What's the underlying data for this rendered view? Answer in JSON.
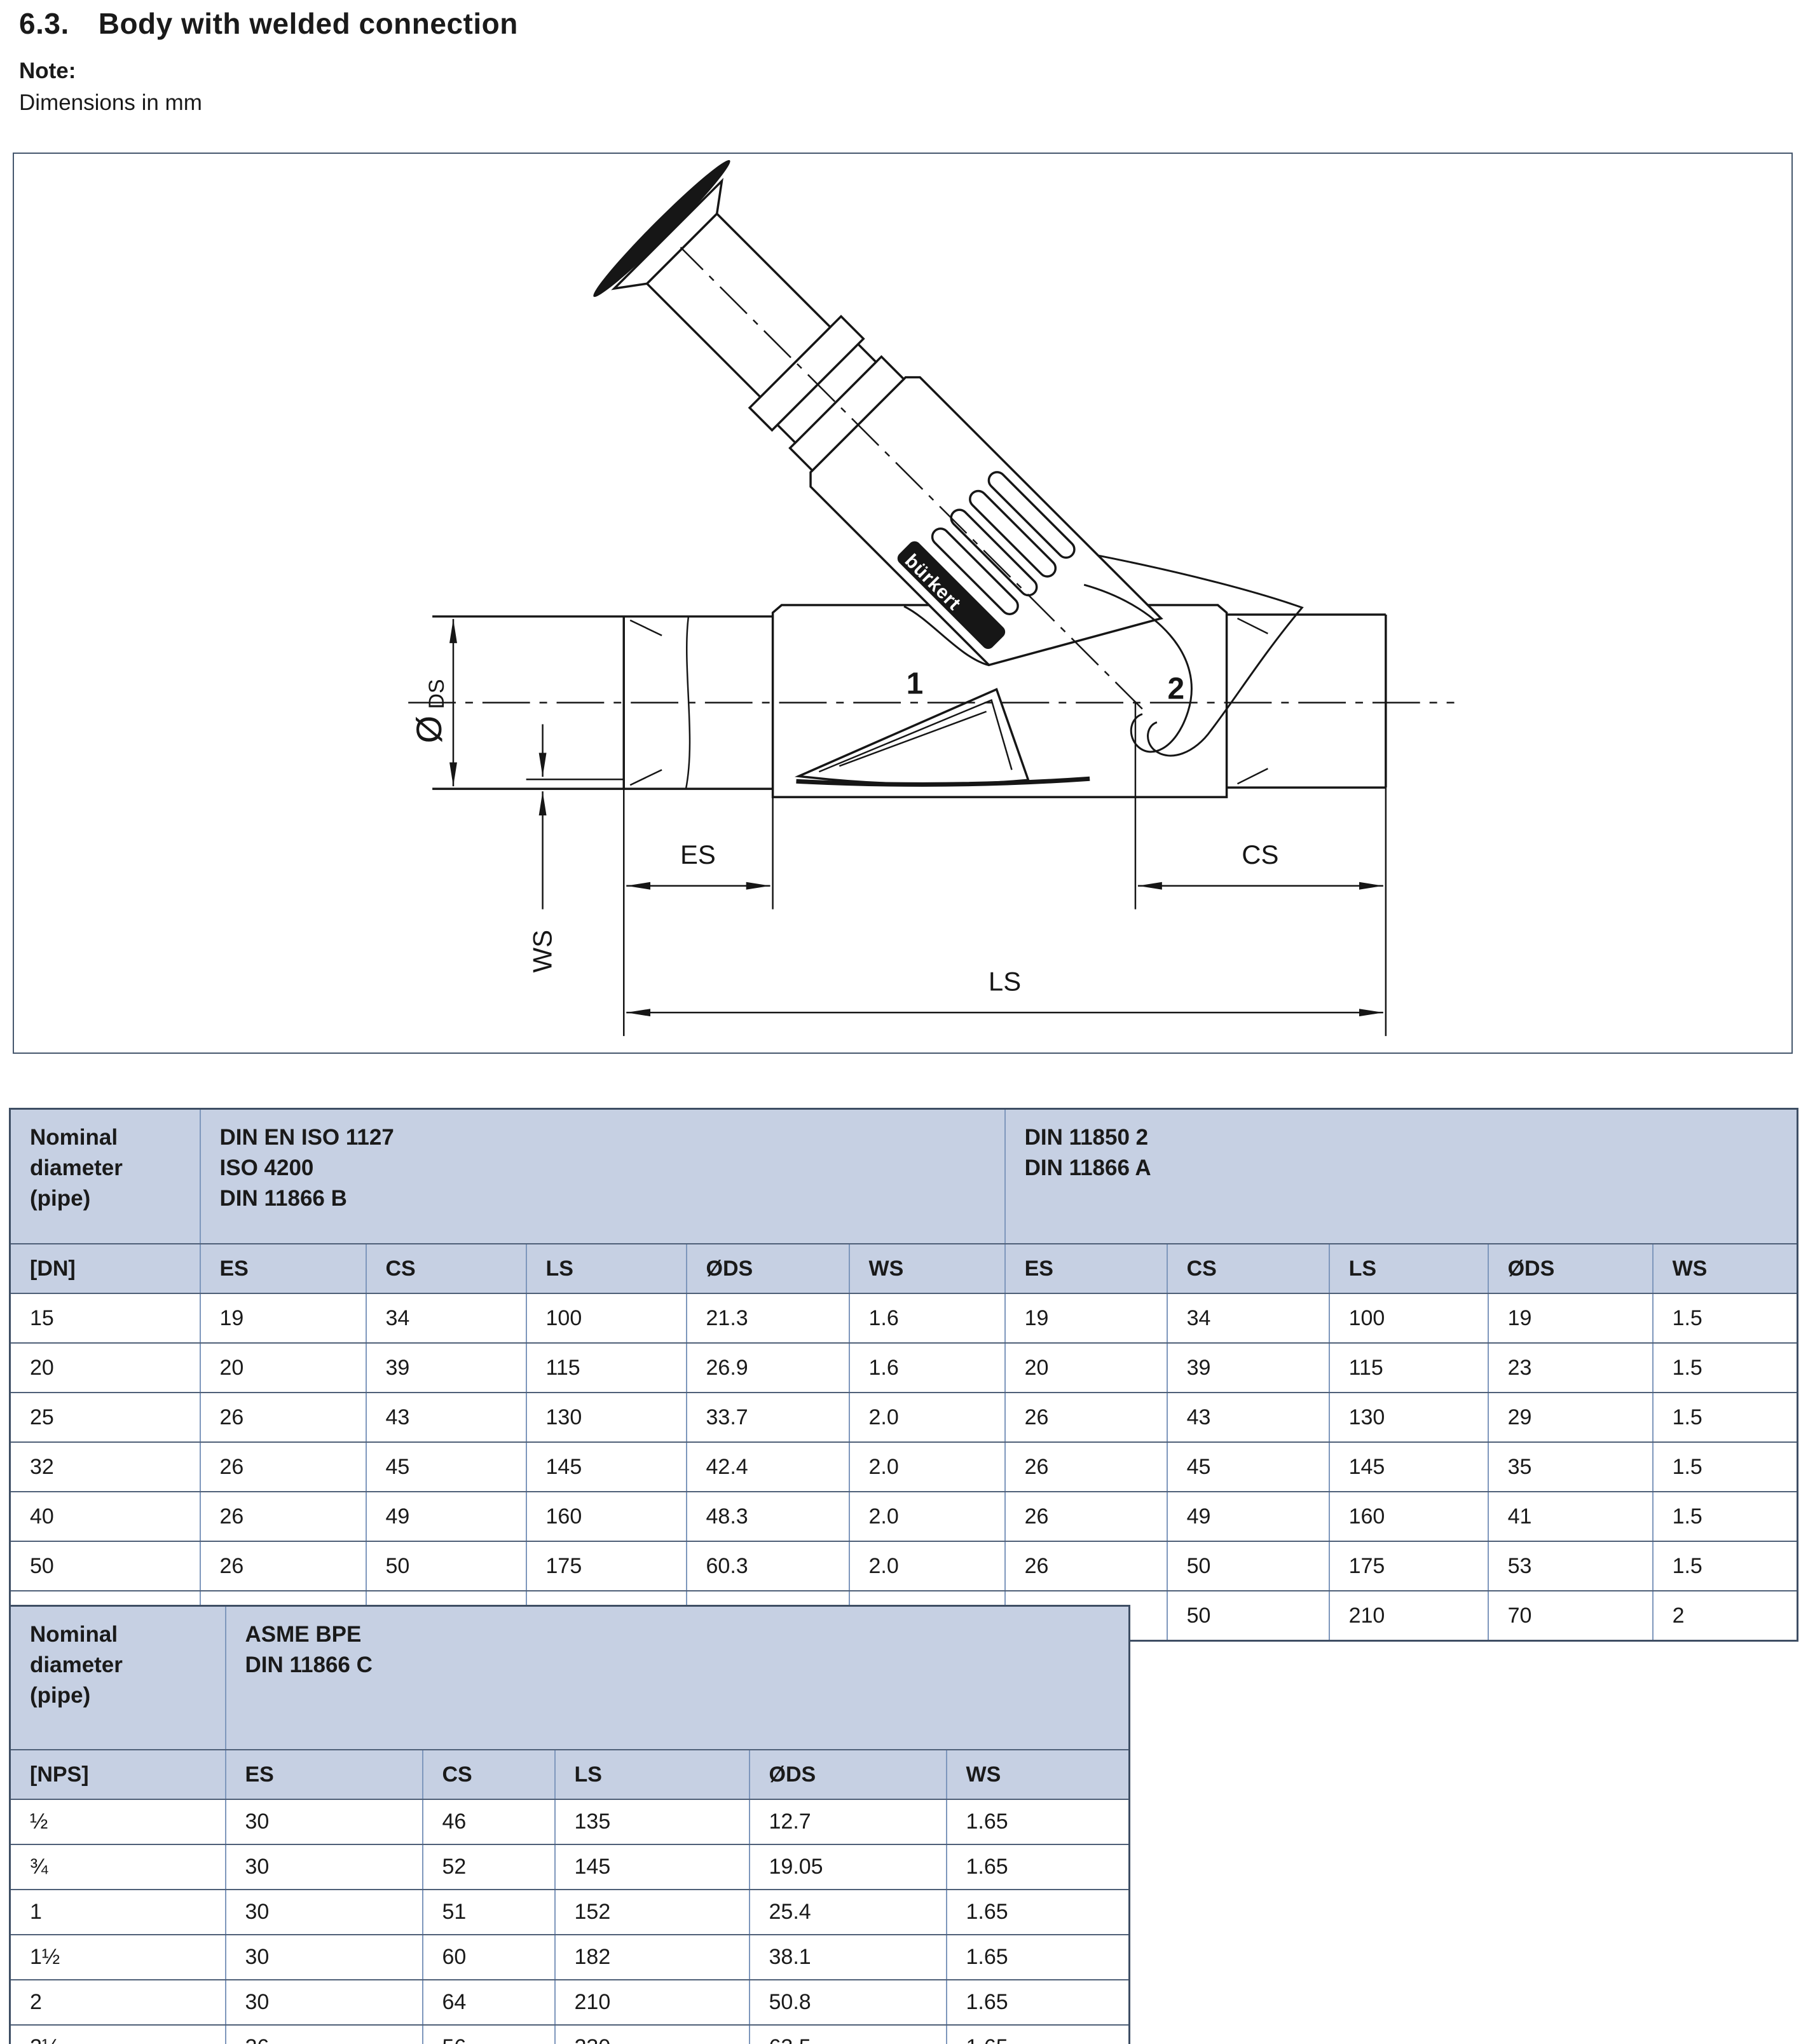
{
  "header": {
    "section_number": "6.3.",
    "title": "Body with welded connection"
  },
  "note": {
    "label": "Note:",
    "text": "Dimensions in mm"
  },
  "drawing": {
    "labels": {
      "port_1": "1",
      "port_2": "2",
      "dim_es": "ES",
      "dim_cs": "CS",
      "dim_ls": "LS",
      "dim_ws": "WS",
      "dim_diameter_symbol": "Ø",
      "dim_diameter_sub": "DS",
      "brand": "bürkert"
    }
  },
  "table_din": {
    "corner_header": "Nominal\ndiameter\n(pipe)",
    "group_headers": [
      "DIN EN ISO 1127\nISO 4200\nDIN 11866 B",
      "DIN 11850 2\nDIN 11866 A"
    ],
    "unit_header": "[DN]",
    "column_headers": [
      "ES",
      "CS",
      "LS",
      "ØDS",
      "WS",
      "ES",
      "CS",
      "LS",
      "ØDS",
      "WS"
    ],
    "rows": [
      [
        "15",
        "19",
        "34",
        "100",
        "21.3",
        "1.6",
        "19",
        "34",
        "100",
        "19",
        "1.5"
      ],
      [
        "20",
        "20",
        "39",
        "115",
        "26.9",
        "1.6",
        "20",
        "39",
        "115",
        "23",
        "1.5"
      ],
      [
        "25",
        "26",
        "43",
        "130",
        "33.7",
        "2.0",
        "26",
        "43",
        "130",
        "29",
        "1.5"
      ],
      [
        "32",
        "26",
        "45",
        "145",
        "42.4",
        "2.0",
        "26",
        "45",
        "145",
        "35",
        "1.5"
      ],
      [
        "40",
        "26",
        "49",
        "160",
        "48.3",
        "2.0",
        "26",
        "49",
        "160",
        "41",
        "1.5"
      ],
      [
        "50",
        "26",
        "50",
        "175",
        "60.3",
        "2.0",
        "26",
        "50",
        "175",
        "53",
        "1.5"
      ],
      [
        "65",
        "26",
        "50",
        "210",
        "76.1",
        "2.3",
        "26",
        "50",
        "210",
        "70",
        "2"
      ]
    ]
  },
  "table_asme": {
    "corner_header": "Nominal\ndiameter\n(pipe)",
    "group_header": "ASME BPE\nDIN 11866 C",
    "unit_header": "[NPS]",
    "column_headers": [
      "ES",
      "CS",
      "LS",
      "ØDS",
      "WS"
    ],
    "rows": [
      [
        "½",
        "30",
        "46",
        "135",
        "12.7",
        "1.65"
      ],
      [
        "¾",
        "30",
        "52",
        "145",
        "19.05",
        "1.65"
      ],
      [
        "1",
        "30",
        "51",
        "152",
        "25.4",
        "1.65"
      ],
      [
        "1½",
        "30",
        "60",
        "182",
        "38.1",
        "1.65"
      ],
      [
        "2",
        "30",
        "64",
        "210",
        "50.8",
        "1.65"
      ],
      [
        "2½",
        "26",
        "56",
        "230",
        "63.5",
        "1.65"
      ]
    ]
  }
}
